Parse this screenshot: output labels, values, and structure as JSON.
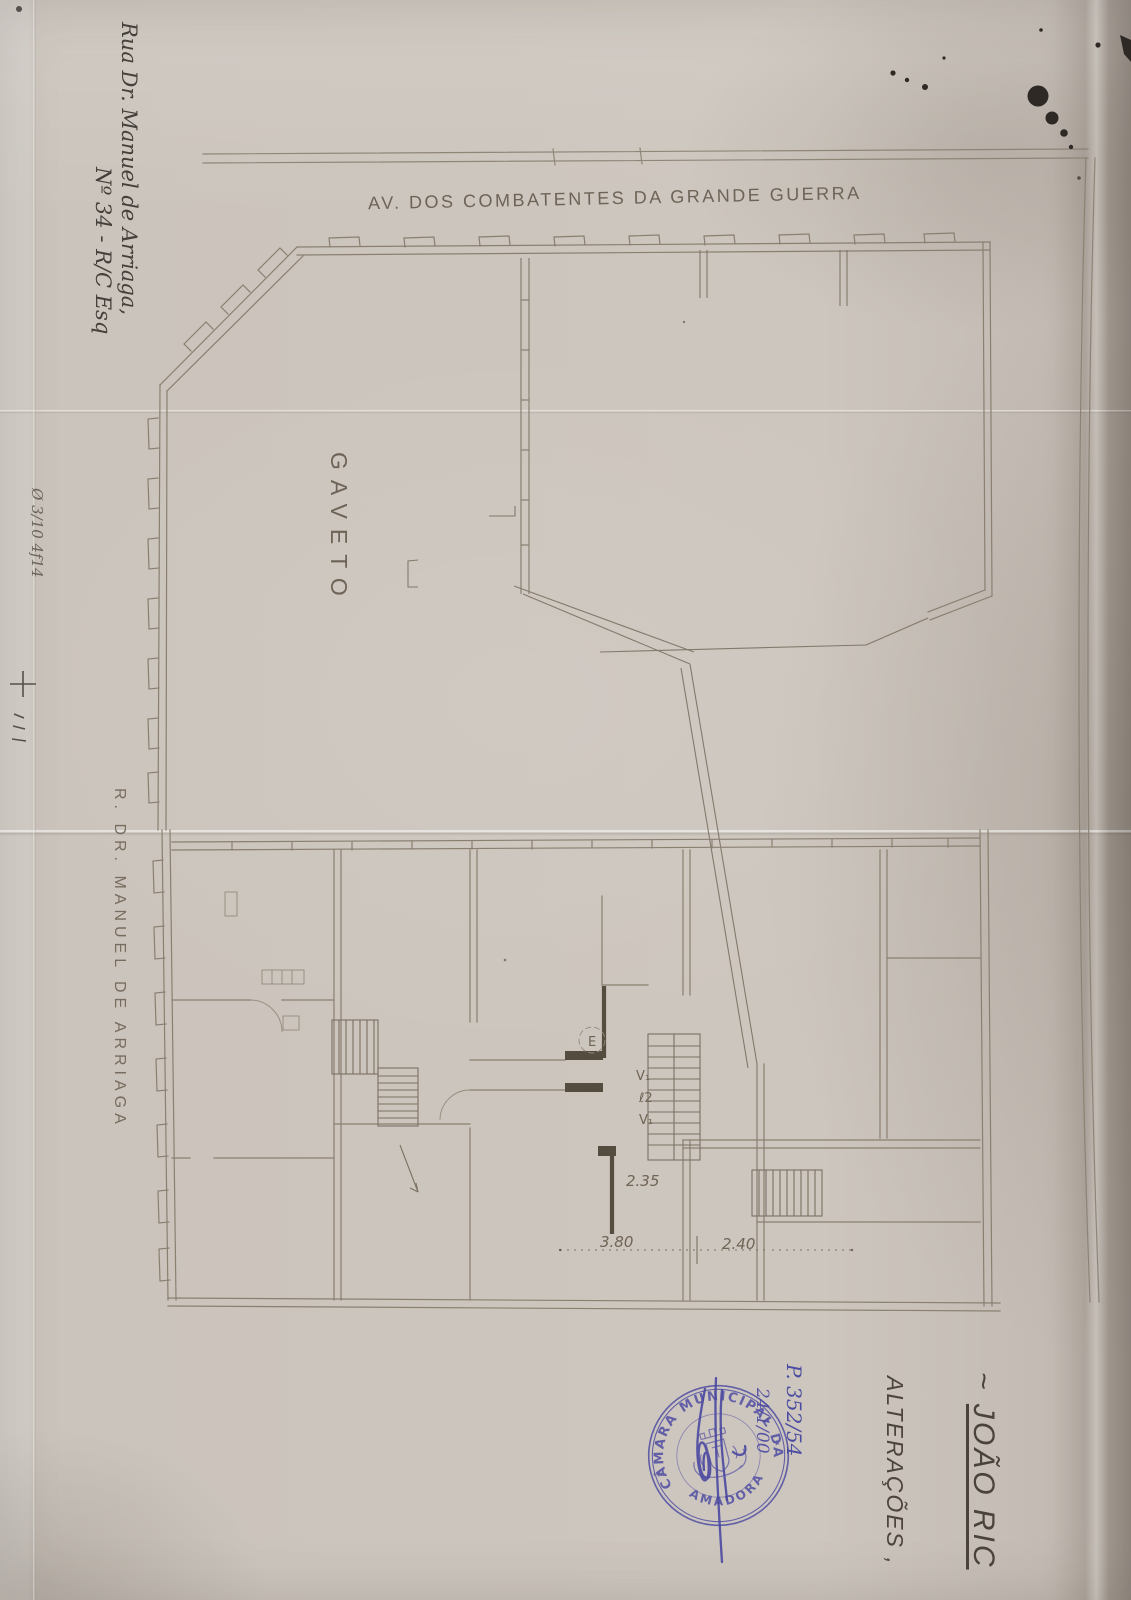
{
  "colors": {
    "paper": "#ccc5bd",
    "pencil": "#8a7f71",
    "pencil_dark": "#544c3e",
    "ink_text": "#45403b",
    "stamp_blue": "#4b49a2",
    "ink_blob": "#2e2925"
  },
  "annotations": {
    "address": {
      "line1": "Rua Dr. Manuel de Arriaga,",
      "line2": "Nº 34 - R/C Esq"
    },
    "margin_note": "Ø 3/10 4f14",
    "title_prefix": "~",
    "title": "JOÃO RIC",
    "subtitle": "ALTERAÇÕES ,"
  },
  "plan": {
    "street_top": "AV. DOS COMBATENTES DA GRANDE GUERRA",
    "street_left": "R. DR. MANUEL DE ARRIAGA",
    "corner_label": "GAVETO",
    "elevator": "E",
    "vent1": "V₁",
    "duct": "ℓ2",
    "vent2": "V₁",
    "dim1": "2.35",
    "dim2": "3.80",
    "dim3": "2.40"
  },
  "stamp": {
    "ring_top": "CÂMARA MUNICIPAL DA",
    "ring_bottom": "AMADORA",
    "separator_left": "★",
    "separator_right": "★",
    "process_number": "P. 352/54",
    "date": "24/1/00"
  }
}
